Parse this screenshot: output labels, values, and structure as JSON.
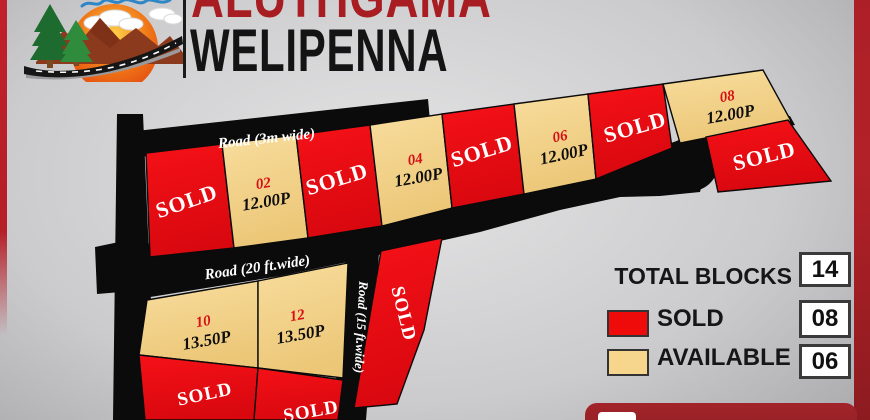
{
  "header": {
    "project_top": "ALUTHGAMA",
    "project_bottom": "WELIPENNA"
  },
  "map": {
    "roads": {
      "road_3m": "Road (3m wide)",
      "road_20ft": "Road (20 ft.wide)",
      "road_15ft": "Road (15 ft.wide)"
    },
    "plots": [
      {
        "status": "sold",
        "label": "SOLD"
      },
      {
        "status": "available",
        "number": "02",
        "area": "12.00P"
      },
      {
        "status": "sold",
        "label": "SOLD"
      },
      {
        "status": "available",
        "number": "04",
        "area": "12.00P"
      },
      {
        "status": "sold",
        "label": "SOLD"
      },
      {
        "status": "available",
        "number": "06",
        "area": "12.00P"
      },
      {
        "status": "sold",
        "label": "SOLD"
      },
      {
        "status": "available",
        "number": "08",
        "area": "12.00P"
      },
      {
        "status": "sold",
        "label": "SOLD"
      },
      {
        "status": "available",
        "number": "10",
        "area": "13.50P"
      },
      {
        "status": "sold",
        "label": "SOLD"
      },
      {
        "status": "available",
        "number": "12",
        "area": "13.50P"
      },
      {
        "status": "sold",
        "label": "SOLD"
      },
      {
        "status": "sold",
        "label": "SOLD"
      }
    ]
  },
  "legend": {
    "title": "TOTAL BLOCKS",
    "total_count": "14",
    "sold_label": "SOLD",
    "sold_count": "08",
    "available_label": "AVAILABLE",
    "available_count": "06"
  },
  "colors": {
    "sold_red": "#ec0c15",
    "available_tan": "#f4d28a",
    "road_black": "#0b0b0b",
    "accent_dark_red": "#9a2126",
    "title_red": "#a81d22",
    "title_black": "#141414"
  }
}
